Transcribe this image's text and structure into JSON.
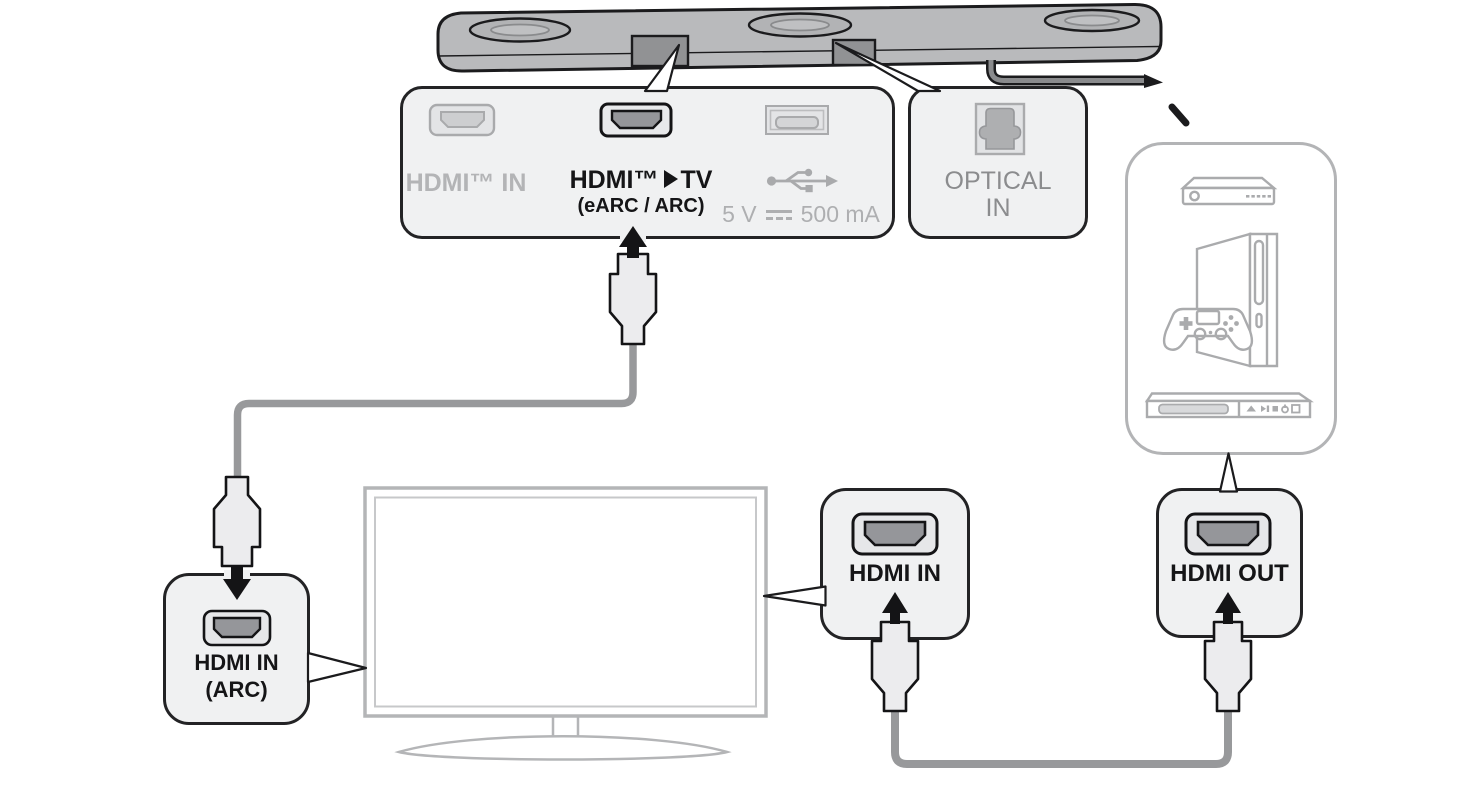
{
  "soundbar_panel": {
    "hdmi_in_label": "HDMI™ IN",
    "hdmi_tv_label_left": "HDMI™",
    "hdmi_tv_label_right": "TV",
    "hdmi_tv_sublabel": "(eARC / ARC)",
    "usb_label_left": "5 V",
    "usb_label_right": "500 mA"
  },
  "optical_panel": {
    "line1": "OPTICAL",
    "line2": "IN"
  },
  "tv_arc_panel": {
    "line1": "HDMI IN",
    "line2": "(ARC)"
  },
  "tv_hdmi_in_panel": {
    "label": "HDMI IN"
  },
  "device_hdmi_out_panel": {
    "label": "HDMI OUT"
  },
  "icons": {
    "usb": "usb-trident-icon",
    "dc_power": "dc-voltage-icon",
    "optical": "optical-port-icon",
    "hdmi_port": "hdmi-port-icon",
    "devices": [
      "set-top-box-icon",
      "game-console-icon",
      "bluray-player-icon"
    ],
    "tv": "tv-icon",
    "soundbar": "soundbar-icon"
  },
  "colors": {
    "panel_fill": "#f0f1f2",
    "panel_border": "#232325",
    "muted_text": "#b3b4b6",
    "gray_text": "#8b8c8e",
    "dark_text": "#151517",
    "device_outline": "#aaabad",
    "cable": "#98999b",
    "soundbar_body": "#b9babc"
  }
}
